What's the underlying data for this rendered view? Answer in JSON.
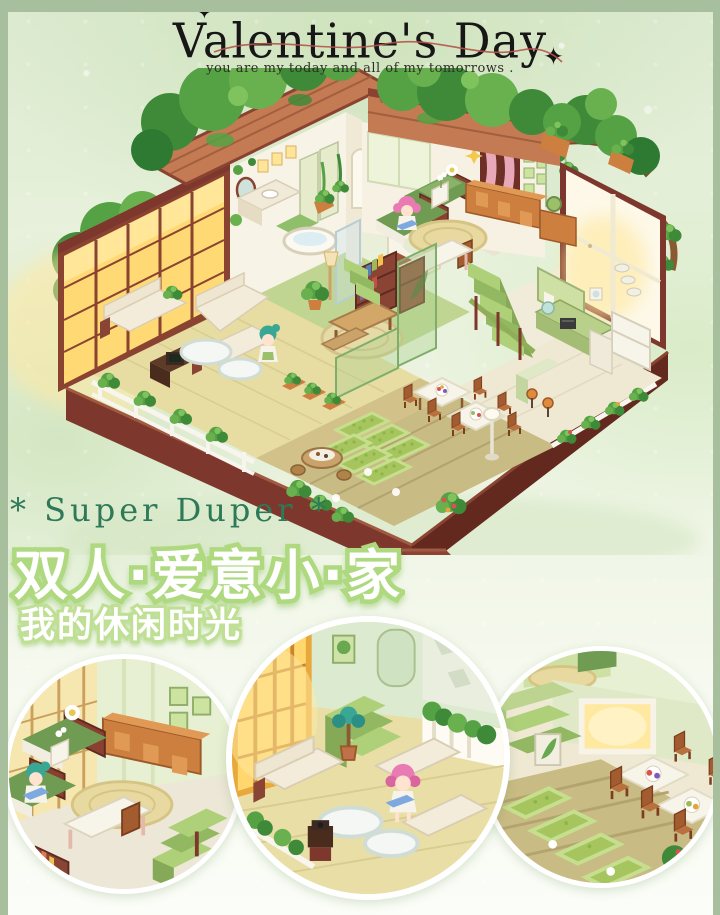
{
  "header": {
    "title": "Valentine's Day",
    "subtitle": "you are my today and all of my tomorrows .",
    "sparkle": "✦"
  },
  "tagline": {
    "super": "* Super Duper *",
    "headline_zh": "双人·爱意小·家",
    "subheadline_zh": "我的休闲时光"
  },
  "colors": {
    "frame_sage": "#a8bf9e",
    "background_green": "#e9f2dd",
    "title_black": "#171717",
    "ribbon_red": "#b5524a",
    "super_green": "#2e7a58",
    "headline_fill": "#ffffff",
    "headline_outline": "#aed97f",
    "wood_maroon": "#7d372c",
    "roof_terracotta": "#c47a52",
    "foliage_green": "#3f8a38",
    "window_glow": "#ffe9a2",
    "bed_green": "#6f9c52",
    "furniture_orange": "#cd7f3f",
    "stair_green": "#aed079"
  }
}
